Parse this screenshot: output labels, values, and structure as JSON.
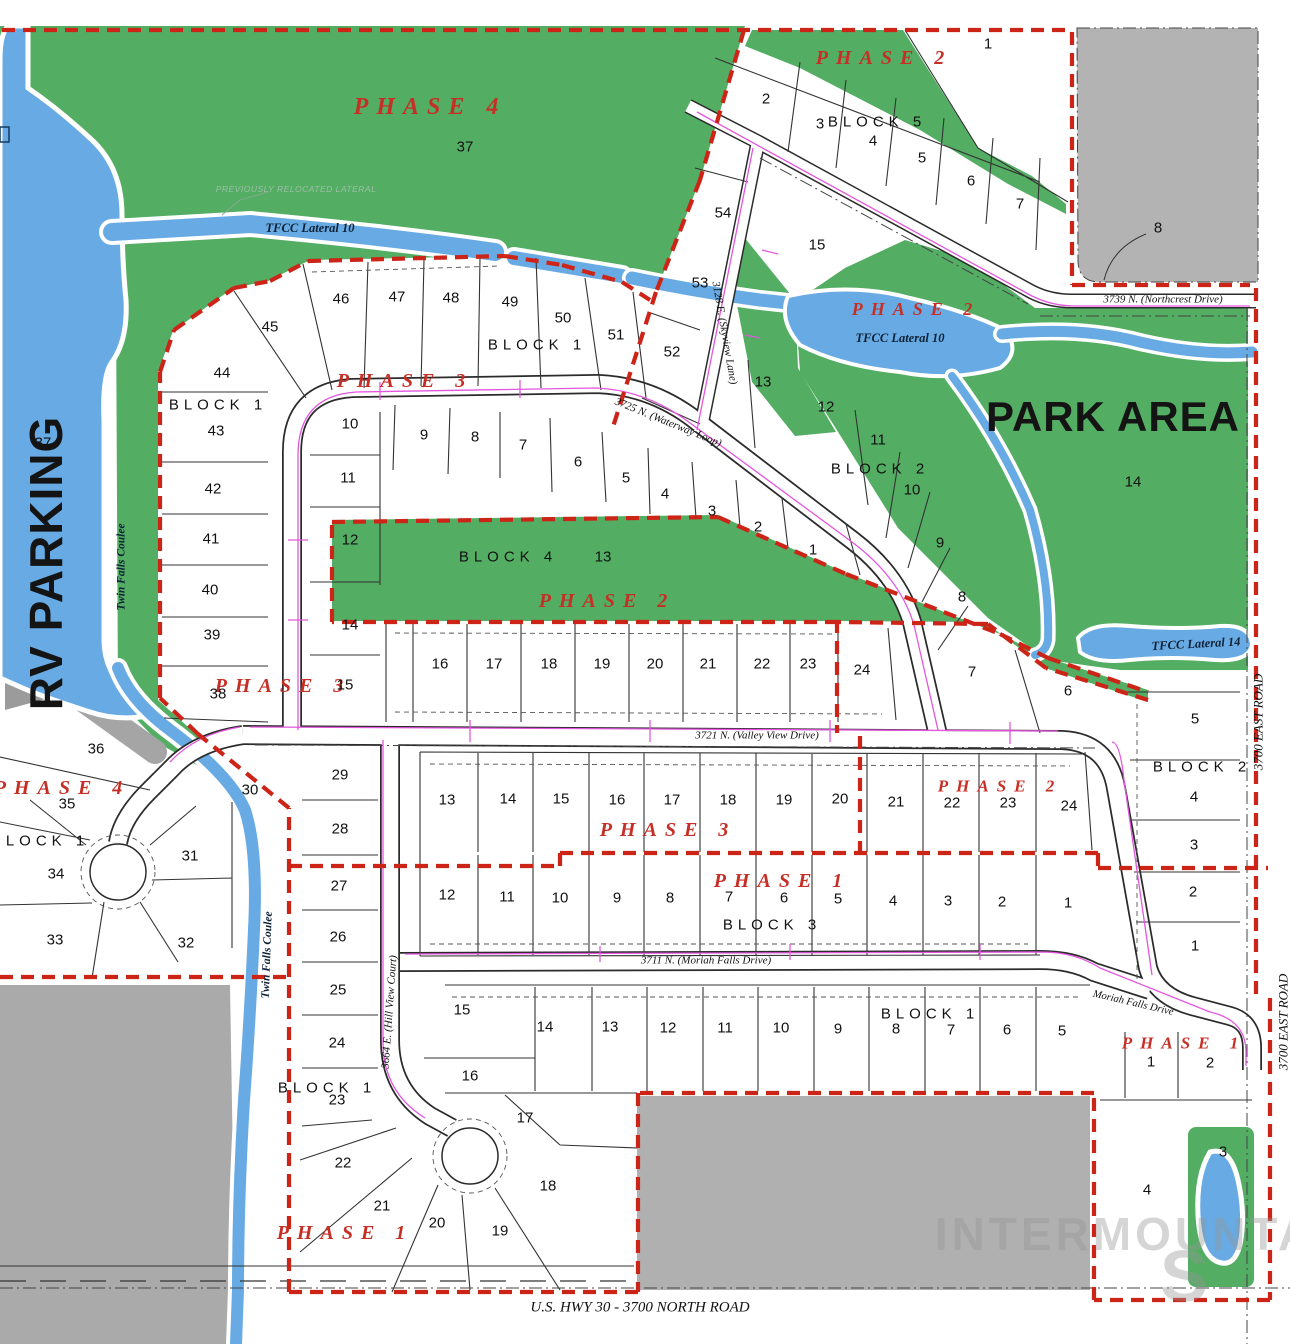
{
  "colors": {
    "park_green": "#53ad63",
    "water_blue": "#68abe4",
    "parcel_gray": "#aaaaaa",
    "parcel_gray_dark": "#9b9b9b",
    "boundary_red": "#cd2418",
    "phase_red": "#c62f26",
    "utility_pink": "#e356de",
    "road_line": "#2b2b2b",
    "page_bg": "#f6f5f2"
  },
  "labels": {
    "groups": [
      {
        "name": "phase-label",
        "cls": "phase",
        "items": [
          [
            "PHASE 4",
            430,
            107,
            24
          ],
          [
            "PHASE 2",
            884,
            58
          ],
          [
            "PHASE 3",
            405,
            381
          ],
          [
            "PHASE 2",
            916,
            309,
            18
          ],
          [
            "PHASE 2",
            607,
            601
          ],
          [
            "PHASE 3",
            283,
            686
          ],
          [
            "PHASE 4",
            62,
            788
          ],
          [
            "PHASE 3",
            668,
            830
          ],
          [
            "PHASE 2",
            1000,
            786,
            17
          ],
          [
            "PHASE 1",
            782,
            881
          ],
          [
            "PHASE 1",
            345,
            1233
          ],
          [
            "PHASE 1",
            1184,
            1043,
            17
          ]
        ]
      },
      {
        "name": "block-label",
        "cls": "block",
        "items": [
          [
            "BLOCK 5",
            877,
            122
          ],
          [
            "BLOCK 1",
            537,
            345
          ],
          [
            "BLOCK 1",
            218,
            405
          ],
          [
            "BLOCK 2",
            880,
            469
          ],
          [
            "BLOCK 4",
            508,
            557
          ],
          [
            "BLOCK 2",
            1202,
            767
          ],
          [
            "BLOCK 3",
            772,
            925
          ],
          [
            "BLOCK 1",
            40,
            841
          ],
          [
            "BLOCK 1",
            930,
            1014
          ],
          [
            "BLOCK 1",
            327,
            1088
          ]
        ]
      },
      {
        "name": "lot-number",
        "cls": "lot",
        "items": [
          [
            "1",
            988,
            44
          ],
          [
            "2",
            766,
            99
          ],
          [
            "3",
            820,
            124
          ],
          [
            "4",
            873,
            141
          ],
          [
            "5",
            922,
            158
          ],
          [
            "6",
            971,
            181
          ],
          [
            "7",
            1020,
            204
          ],
          [
            "54",
            723,
            213
          ],
          [
            "15",
            817,
            245
          ],
          [
            "53",
            700,
            283
          ],
          [
            "52",
            672,
            352
          ],
          [
            "51",
            616,
            335
          ],
          [
            "50",
            563,
            318
          ],
          [
            "49",
            510,
            302
          ],
          [
            "48",
            451,
            298
          ],
          [
            "47",
            397,
            297
          ],
          [
            "46",
            341,
            299
          ],
          [
            "45",
            270,
            327
          ],
          [
            "44",
            222,
            373
          ],
          [
            "43",
            216,
            431
          ],
          [
            "42",
            213,
            489
          ],
          [
            "41",
            211,
            539
          ],
          [
            "40",
            210,
            590
          ],
          [
            "39",
            212,
            635
          ],
          [
            "38",
            218,
            694
          ],
          [
            "10",
            350,
            424
          ],
          [
            "9",
            424,
            435
          ],
          [
            "8",
            475,
            437
          ],
          [
            "7",
            523,
            445
          ],
          [
            "6",
            578,
            462
          ],
          [
            "5",
            626,
            478
          ],
          [
            "4",
            665,
            494
          ],
          [
            "3",
            712,
            511
          ],
          [
            "2",
            758,
            527
          ],
          [
            "1",
            813,
            550
          ],
          [
            "11",
            348,
            478
          ],
          [
            "12",
            350,
            540
          ],
          [
            "14",
            350,
            625
          ],
          [
            "15",
            345,
            685
          ],
          [
            "13",
            763,
            382
          ],
          [
            "12",
            826,
            407
          ],
          [
            "11",
            878,
            440
          ],
          [
            "10",
            912,
            490
          ],
          [
            "9",
            940,
            543
          ],
          [
            "8",
            962,
            597
          ],
          [
            "7",
            972,
            672
          ],
          [
            "6",
            1068,
            691
          ],
          [
            "13",
            603,
            557
          ],
          [
            "16",
            440,
            664
          ],
          [
            "17",
            494,
            664
          ],
          [
            "18",
            549,
            664
          ],
          [
            "19",
            602,
            664
          ],
          [
            "20",
            655,
            664
          ],
          [
            "21",
            708,
            664
          ],
          [
            "22",
            762,
            664
          ],
          [
            "23",
            808,
            664
          ],
          [
            "24",
            862,
            670
          ],
          [
            "5",
            1195,
            719
          ],
          [
            "4",
            1194,
            797
          ],
          [
            "3",
            1194,
            845
          ],
          [
            "2",
            1193,
            892
          ],
          [
            "1",
            1195,
            946
          ],
          [
            "29",
            340,
            775
          ],
          [
            "28",
            340,
            829
          ],
          [
            "27",
            339,
            886
          ],
          [
            "26",
            338,
            937
          ],
          [
            "25",
            338,
            990
          ],
          [
            "24",
            337,
            1043
          ],
          [
            "23",
            337,
            1100
          ],
          [
            "30",
            250,
            790
          ],
          [
            "36",
            96,
            749
          ],
          [
            "35",
            67,
            804
          ],
          [
            "34",
            56,
            874
          ],
          [
            "33",
            55,
            940
          ],
          [
            "32",
            186,
            943
          ],
          [
            "31",
            190,
            856
          ],
          [
            "13",
            447,
            800
          ],
          [
            "14",
            508,
            799
          ],
          [
            "15",
            561,
            799
          ],
          [
            "16",
            617,
            800
          ],
          [
            "17",
            672,
            800
          ],
          [
            "18",
            728,
            800
          ],
          [
            "19",
            784,
            800
          ],
          [
            "20",
            840,
            799
          ],
          [
            "21",
            896,
            802
          ],
          [
            "22",
            952,
            803
          ],
          [
            "23",
            1008,
            803
          ],
          [
            "24",
            1069,
            806
          ],
          [
            "12",
            447,
            895
          ],
          [
            "11",
            507,
            897
          ],
          [
            "10",
            560,
            898
          ],
          [
            "9",
            617,
            898
          ],
          [
            "8",
            670,
            898
          ],
          [
            "7",
            729,
            897
          ],
          [
            "6",
            784,
            898
          ],
          [
            "5",
            838,
            899
          ],
          [
            "4",
            893,
            901
          ],
          [
            "3",
            948,
            901
          ],
          [
            "2",
            1002,
            902
          ],
          [
            "1",
            1068,
            903
          ],
          [
            "15",
            462,
            1010
          ],
          [
            "14",
            545,
            1027
          ],
          [
            "13",
            610,
            1027
          ],
          [
            "12",
            668,
            1028
          ],
          [
            "11",
            725,
            1028
          ],
          [
            "10",
            781,
            1028
          ],
          [
            "9",
            838,
            1029
          ],
          [
            "8",
            896,
            1029
          ],
          [
            "7",
            951,
            1030
          ],
          [
            "6",
            1007,
            1030
          ],
          [
            "5",
            1062,
            1031
          ],
          [
            "16",
            470,
            1076
          ],
          [
            "17",
            525,
            1118
          ],
          [
            "18",
            548,
            1186
          ],
          [
            "19",
            500,
            1231
          ],
          [
            "20",
            437,
            1223
          ],
          [
            "21",
            382,
            1206
          ],
          [
            "22",
            343,
            1163
          ],
          [
            "1",
            1151,
            1062
          ],
          [
            "2",
            1210,
            1063
          ],
          [
            "3",
            1223,
            1152
          ],
          [
            "4",
            1147,
            1190
          ],
          [
            "37",
            465,
            147
          ],
          [
            "37",
            43,
            443
          ],
          [
            "14",
            1133,
            482
          ],
          [
            "8",
            1158,
            228
          ]
        ]
      },
      {
        "name": "street-label",
        "cls": "street",
        "items": [
          [
            "3739 N. (Northcrest Drive)",
            1163,
            300
          ],
          [
            "3725 N. (Waterway Loop)",
            668,
            423,
            11,
            22
          ],
          [
            "3128 E. (Skyview Lane)",
            724,
            333,
            11,
            80
          ],
          [
            "3721 N. (Valley View Drive)",
            757,
            736
          ],
          [
            "3711 N.  (Moriah Falls Drive)",
            706,
            961
          ],
          [
            "3664 E. (Hill View Court)",
            390,
            1012,
            11,
            -86
          ],
          [
            "Moriah Falls Drive",
            1133,
            1004,
            10.5,
            13
          ],
          [
            "U.S. HWY 30 - 3700 NORTH ROAD",
            640,
            1308,
            15
          ],
          [
            "3700 EAST ROAD",
            1258,
            722,
            13,
            -90
          ],
          [
            "3700 EAST ROAD",
            1283,
            1022,
            13,
            -90
          ]
        ]
      },
      {
        "name": "water-label",
        "cls": "water",
        "items": [
          [
            "TFCC Lateral 10",
            310,
            228
          ],
          [
            "TFCC Lateral 10",
            900,
            338
          ],
          [
            "TFCC Lateral 14",
            1196,
            644,
            12.5,
            -3
          ],
          [
            "Twin Falls Coulee",
            122,
            567,
            11.5,
            -90
          ],
          [
            "Twin Falls Coulee",
            268,
            955,
            11.5,
            -88
          ]
        ]
      },
      {
        "name": "area-label",
        "cls": "area",
        "items": [
          [
            "PARK AREA",
            1113,
            417,
            42
          ],
          [
            "RV PARKING",
            46,
            563,
            46,
            -90
          ]
        ]
      },
      {
        "name": "annotation-label",
        "cls": "annot",
        "items": [
          [
            "PREVIOUSLY RELOCATED LATERAL",
            296,
            189,
            8.5
          ]
        ]
      },
      {
        "name": "watermark",
        "cls": "wm",
        "items": [
          [
            "INTERMOUNTAIN",
            1152,
            1234,
            46
          ],
          [
            "S",
            1186,
            1277,
            72
          ]
        ]
      }
    ]
  }
}
